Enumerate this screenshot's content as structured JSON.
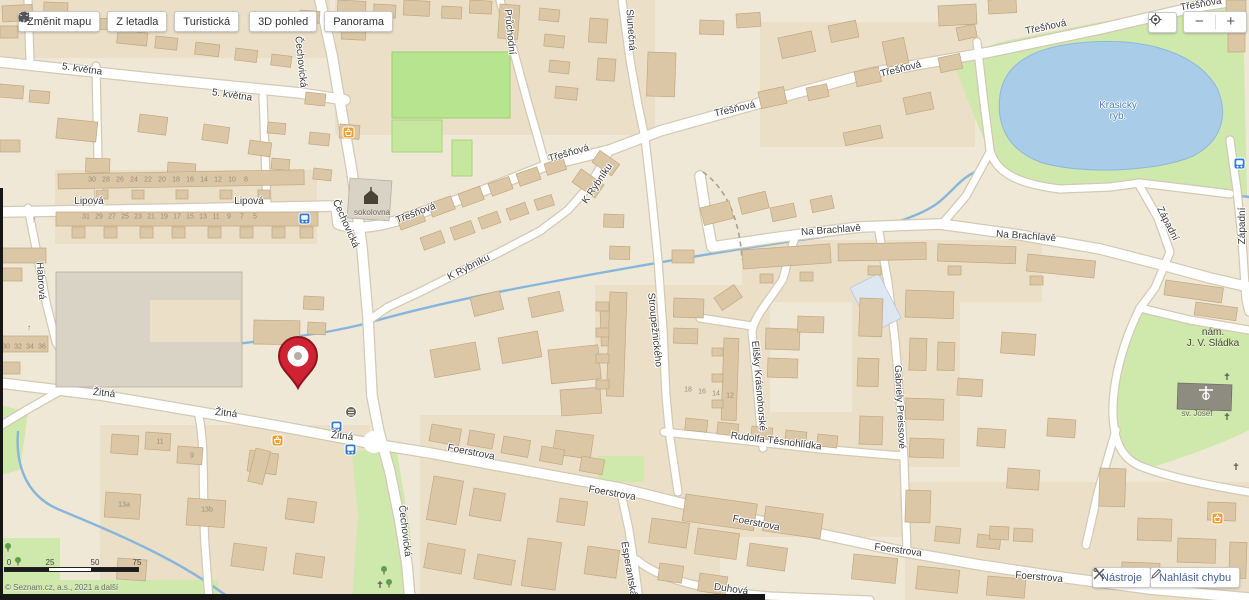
{
  "toolbar": {
    "buttons": [
      {
        "label": "Změnit mapu",
        "icon": "map-icon"
      },
      {
        "label": "Z letadla",
        "icon": "plane-icon"
      },
      {
        "label": "Turistická",
        "icon": "mountains-icon"
      },
      {
        "label": "3D pohled",
        "icon": "cube-icon"
      },
      {
        "label": "Panorama",
        "icon": "panorama-icon"
      }
    ]
  },
  "zoom_controls": {
    "zoom_out_label": "−",
    "zoom_in_label": "+"
  },
  "footer_buttons": {
    "tools_label": "Nástroje",
    "report_label": "Nahlásit chybu"
  },
  "scale": {
    "tick_labels": [
      "0",
      "25",
      "50",
      "75"
    ],
    "attribution": "© Seznam.cz, a.s., 2021 a další"
  },
  "map": {
    "marker": {
      "x": 277,
      "y": 336,
      "color": "#cf2233"
    },
    "colors": {
      "land": "#f0e8d6",
      "water": "#a9cce9",
      "green": "#cfe8ab",
      "road": "#ffffff",
      "pin": "#cf2233"
    },
    "labels": [
      {
        "t": "5. května",
        "x": 82,
        "y": 70,
        "r": 8,
        "c": "st"
      },
      {
        "t": "5. května",
        "x": 232,
        "y": 96,
        "r": 8,
        "c": "st"
      },
      {
        "t": "Lipová",
        "x": 89,
        "y": 202,
        "r": 0,
        "c": "st"
      },
      {
        "t": "Lipová",
        "x": 249,
        "y": 202,
        "r": 0,
        "c": "st"
      },
      {
        "t": "Čechovická",
        "x": 300,
        "y": 62,
        "r": 84,
        "c": "st"
      },
      {
        "t": "Čechovická",
        "x": 345,
        "y": 224,
        "r": 66,
        "c": "st"
      },
      {
        "t": "Čechovická",
        "x": 404,
        "y": 531,
        "r": 83,
        "c": "st"
      },
      {
        "t": "Třešňová",
        "x": 416,
        "y": 214,
        "r": -21,
        "c": "st"
      },
      {
        "t": "Třešňová",
        "x": 569,
        "y": 154,
        "r": -16,
        "c": "st"
      },
      {
        "t": "Třešňová",
        "x": 735,
        "y": 110,
        "r": -13,
        "c": "st"
      },
      {
        "t": "Třešňová",
        "x": 901,
        "y": 70,
        "r": -14,
        "c": "st"
      },
      {
        "t": "Třešňová",
        "x": 1046,
        "y": 28,
        "r": -12,
        "c": "st"
      },
      {
        "t": "Třešňová",
        "x": 1201,
        "y": 5,
        "r": -10,
        "c": "st"
      },
      {
        "t": "K Rybníku",
        "x": 469,
        "y": 268,
        "r": -27,
        "c": "st"
      },
      {
        "t": "K Rybníku",
        "x": 598,
        "y": 184,
        "r": -56,
        "c": "st"
      },
      {
        "t": "Průchodní",
        "x": 509,
        "y": 32,
        "r": 84,
        "c": "st"
      },
      {
        "t": "Slunečná",
        "x": 630,
        "y": 30,
        "r": 86,
        "c": "st"
      },
      {
        "t": "Na Brachlavě",
        "x": 831,
        "y": 231,
        "r": -4,
        "c": "st"
      },
      {
        "t": "Na Brachlavě",
        "x": 1026,
        "y": 237,
        "r": 4,
        "c": "st"
      },
      {
        "t": "Západní",
        "x": 1167,
        "y": 224,
        "r": 63,
        "c": "st"
      },
      {
        "t": "Západní",
        "x": 1243,
        "y": 226,
        "r": -90,
        "c": "st"
      },
      {
        "t": "Stroupežnického",
        "x": 654,
        "y": 330,
        "r": 84,
        "c": "st"
      },
      {
        "t": "Elišky Krásnohorské",
        "x": 758,
        "y": 386,
        "r": 85,
        "c": "st"
      },
      {
        "t": "Rudolfa Těsnohlídka",
        "x": 776,
        "y": 442,
        "r": 7,
        "c": "st"
      },
      {
        "t": "Gabriely Preissové",
        "x": 899,
        "y": 407,
        "r": 87,
        "c": "st"
      },
      {
        "t": "Žitná",
        "x": 104,
        "y": 394,
        "r": 6,
        "c": "st"
      },
      {
        "t": "Žitná",
        "x": 226,
        "y": 414,
        "r": 6,
        "c": "st"
      },
      {
        "t": "Žitná",
        "x": 342,
        "y": 437,
        "r": 6,
        "c": "st"
      },
      {
        "t": "Foerstrova",
        "x": 471,
        "y": 453,
        "r": 11,
        "c": "st"
      },
      {
        "t": "Foerstrova",
        "x": 612,
        "y": 494,
        "r": 10,
        "c": "st"
      },
      {
        "t": "Foerstrova",
        "x": 756,
        "y": 524,
        "r": 11,
        "c": "st"
      },
      {
        "t": "Foerstrova",
        "x": 898,
        "y": 551,
        "r": 8,
        "c": "st"
      },
      {
        "t": "Foerstrova",
        "x": 1039,
        "y": 578,
        "r": 5,
        "c": "st"
      },
      {
        "t": "Esperantská",
        "x": 628,
        "y": 569,
        "r": 80,
        "c": "st"
      },
      {
        "t": "Duhová",
        "x": 731,
        "y": 590,
        "r": 8,
        "c": "st"
      },
      {
        "t": "Habrová",
        "x": 40,
        "y": 281,
        "r": 86,
        "c": "st"
      },
      {
        "t": "Krasický",
        "x": 1118,
        "y": 106,
        "r": 0,
        "c": "wt"
      },
      {
        "t": "ryb.",
        "x": 1118,
        "y": 117,
        "r": 0,
        "c": "wt"
      },
      {
        "t": "nám.",
        "x": 1213,
        "y": 333,
        "r": 0,
        "c": "ar"
      },
      {
        "t": "J. V. Sládka",
        "x": 1213,
        "y": 344,
        "r": 0,
        "c": "ar"
      },
      {
        "t": "sokolovna",
        "x": 372,
        "y": 213,
        "r": 0,
        "c": "poi"
      },
      {
        "t": "sv. Josef",
        "x": 1197,
        "y": 414,
        "r": 0,
        "c": "poi"
      },
      {
        "t": "30",
        "x": 92,
        "y": 180,
        "r": 0,
        "c": "nm"
      },
      {
        "t": "28",
        "x": 106,
        "y": 180,
        "r": 0,
        "c": "nm"
      },
      {
        "t": "26",
        "x": 120,
        "y": 180,
        "r": 0,
        "c": "nm"
      },
      {
        "t": "24",
        "x": 134,
        "y": 180,
        "r": 0,
        "c": "nm"
      },
      {
        "t": "22",
        "x": 148,
        "y": 180,
        "r": 0,
        "c": "nm"
      },
      {
        "t": "20",
        "x": 162,
        "y": 180,
        "r": 0,
        "c": "nm"
      },
      {
        "t": "18",
        "x": 176,
        "y": 180,
        "r": 0,
        "c": "nm"
      },
      {
        "t": "16",
        "x": 190,
        "y": 180,
        "r": 0,
        "c": "nm"
      },
      {
        "t": "14",
        "x": 204,
        "y": 180,
        "r": 0,
        "c": "nm"
      },
      {
        "t": "12",
        "x": 218,
        "y": 180,
        "r": 0,
        "c": "nm"
      },
      {
        "t": "10",
        "x": 232,
        "y": 180,
        "r": 0,
        "c": "nm"
      },
      {
        "t": "8",
        "x": 246,
        "y": 180,
        "r": 0,
        "c": "nm"
      },
      {
        "t": "31",
        "x": 86,
        "y": 217,
        "r": 0,
        "c": "nm"
      },
      {
        "t": "29",
        "x": 99,
        "y": 217,
        "r": 0,
        "c": "nm"
      },
      {
        "t": "27",
        "x": 112,
        "y": 217,
        "r": 0,
        "c": "nm"
      },
      {
        "t": "25",
        "x": 125,
        "y": 217,
        "r": 0,
        "c": "nm"
      },
      {
        "t": "23",
        "x": 138,
        "y": 217,
        "r": 0,
        "c": "nm"
      },
      {
        "t": "21",
        "x": 151,
        "y": 217,
        "r": 0,
        "c": "nm"
      },
      {
        "t": "19",
        "x": 164,
        "y": 217,
        "r": 0,
        "c": "nm"
      },
      {
        "t": "17",
        "x": 177,
        "y": 217,
        "r": 0,
        "c": "nm"
      },
      {
        "t": "15",
        "x": 190,
        "y": 217,
        "r": 0,
        "c": "nm"
      },
      {
        "t": "13",
        "x": 203,
        "y": 217,
        "r": 0,
        "c": "nm"
      },
      {
        "t": "11",
        "x": 216,
        "y": 217,
        "r": 0,
        "c": "nm"
      },
      {
        "t": "9",
        "x": 229,
        "y": 217,
        "r": 0,
        "c": "nm"
      },
      {
        "t": "7",
        "x": 242,
        "y": 217,
        "r": 0,
        "c": "nm"
      },
      {
        "t": "5",
        "x": 255,
        "y": 217,
        "r": 0,
        "c": "nm"
      },
      {
        "t": "30",
        "x": 6,
        "y": 347,
        "r": 0,
        "c": "nm"
      },
      {
        "t": "32",
        "x": 18,
        "y": 347,
        "r": 0,
        "c": "nm"
      },
      {
        "t": "34",
        "x": 30,
        "y": 347,
        "r": 0,
        "c": "nm"
      },
      {
        "t": "36",
        "x": 42,
        "y": 347,
        "r": 0,
        "c": "nm"
      },
      {
        "t": "11",
        "x": 160,
        "y": 442,
        "r": 0,
        "c": "nm"
      },
      {
        "t": "9",
        "x": 192,
        "y": 456,
        "r": 0,
        "c": "nm"
      },
      {
        "t": "13a",
        "x": 124,
        "y": 505,
        "r": 0,
        "c": "nm"
      },
      {
        "t": "13b",
        "x": 207,
        "y": 510,
        "r": 0,
        "c": "nm"
      },
      {
        "t": "18",
        "x": 688,
        "y": 390,
        "r": 0,
        "c": "nm"
      },
      {
        "t": "16",
        "x": 702,
        "y": 392,
        "r": 0,
        "c": "nm"
      },
      {
        "t": "14",
        "x": 716,
        "y": 394,
        "r": 0,
        "c": "nm"
      },
      {
        "t": "12",
        "x": 730,
        "y": 396,
        "r": 0,
        "c": "nm"
      },
      {
        "t": "↑",
        "x": 34,
        "y": 220,
        "r": 6,
        "c": "arw"
      },
      {
        "t": "↑",
        "x": 29,
        "y": 328,
        "r": 4,
        "c": "arw"
      }
    ]
  }
}
